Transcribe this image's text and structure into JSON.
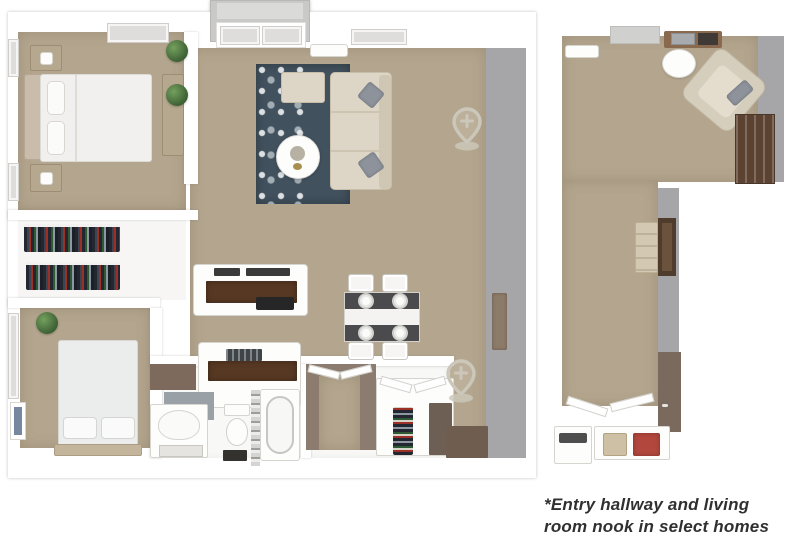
{
  "caption": {
    "line1": "*Entry hallway and living",
    "line2": "room nook in select homes"
  },
  "icons": {
    "location_pin": {
      "name": "location-pin-icon",
      "glyph": "plus-inside-map-pin",
      "count": 2
    }
  },
  "colors": {
    "floor": "#b4a68e",
    "wall_gray": "#a6a6a8",
    "rug": "#41515d",
    "sofa_beige": "#ddd5c5",
    "counter_wood": "#573823",
    "desk_wood": "#8a6a4e",
    "bookshelf_wood": "#5c4331",
    "taupe_wall": "#8c7c70",
    "entry_mat": "#6f5e50",
    "door_wood": "#8d7b69",
    "pin": "#cbc7ba",
    "plant": "#4a7040",
    "red_accent": "#b2473d",
    "bag_beige": "#cec0a5",
    "caption_text": "#303030"
  }
}
